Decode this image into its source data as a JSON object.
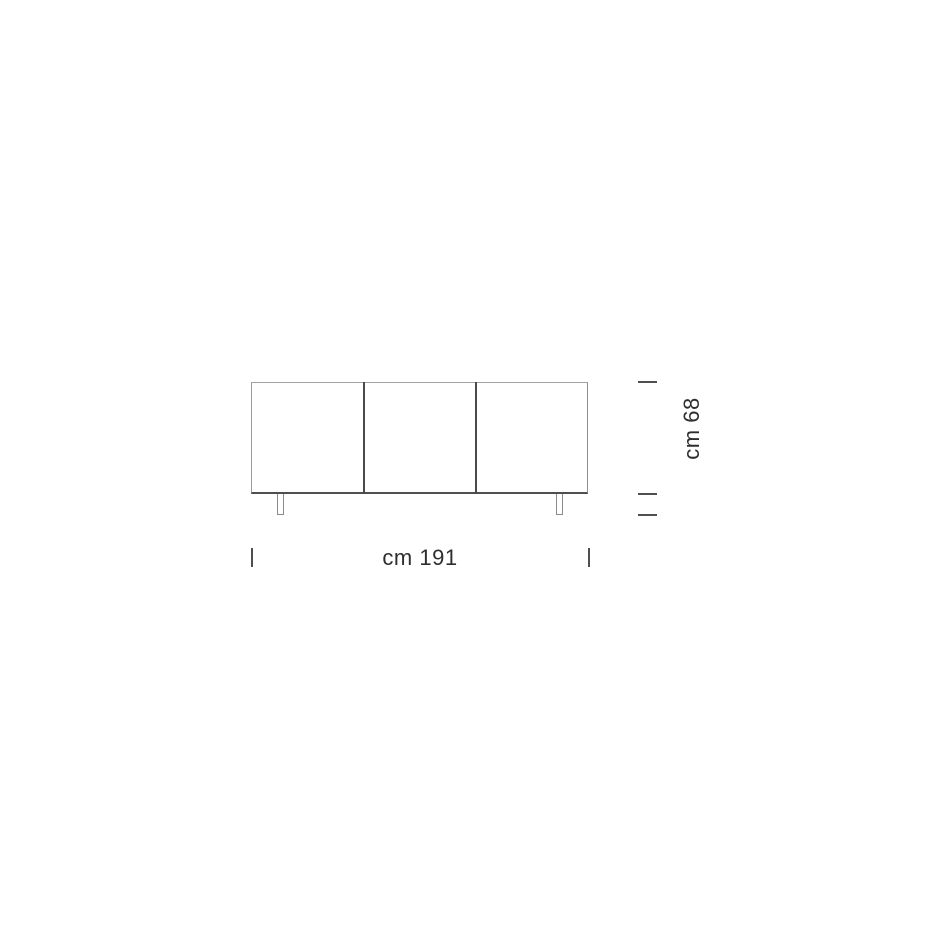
{
  "diagram": {
    "subject": "sideboard-front-elevation-drawing",
    "doors_count": 3,
    "legs_count": 2,
    "dimensions": {
      "unit": "cm",
      "width_value": "191",
      "height_value": "68",
      "width_label": "cm 191",
      "height_label": "cm 68"
    },
    "colors": {
      "background": "#ffffff",
      "outline_light": "#9a9a9a",
      "outline_dark": "#4a4a4a",
      "tick": "#4f4f4f",
      "text": "#2e2e2e"
    }
  }
}
